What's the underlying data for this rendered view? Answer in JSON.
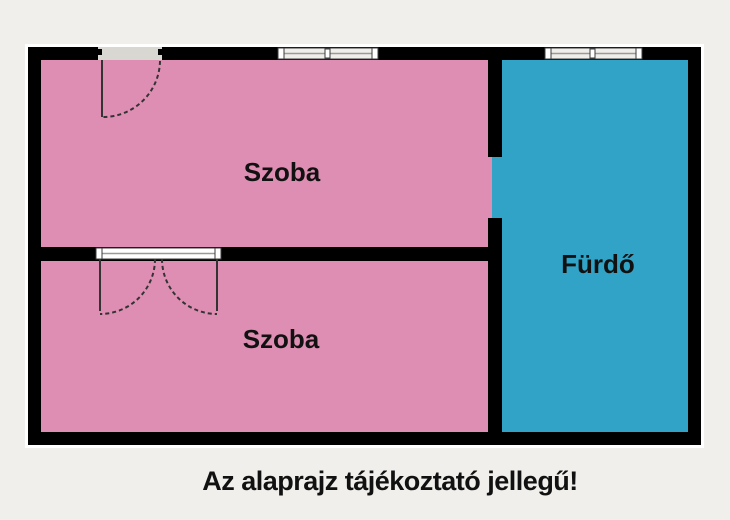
{
  "floorplan": {
    "rooms": [
      {
        "id": "szoba-top",
        "label": "Szoba"
      },
      {
        "id": "szoba-bottom",
        "label": "Szoba"
      },
      {
        "id": "furdo",
        "label": "Fürdő"
      }
    ],
    "caption": "Az alaprajz tájékoztató jellegű!"
  },
  "colors": {
    "background": "#f0efeb",
    "wall": "#000000",
    "wall_outline": "#ffffff",
    "room_fill": "#df8eb3",
    "bathroom_fill": "#31a3c7",
    "opening_fill": "#d9d7d2",
    "window_fill": "#efeeea",
    "window_stroke": "#3c3c3c",
    "mullion": "#9a9a96",
    "door_stroke": "#333333",
    "text": "#111111"
  }
}
